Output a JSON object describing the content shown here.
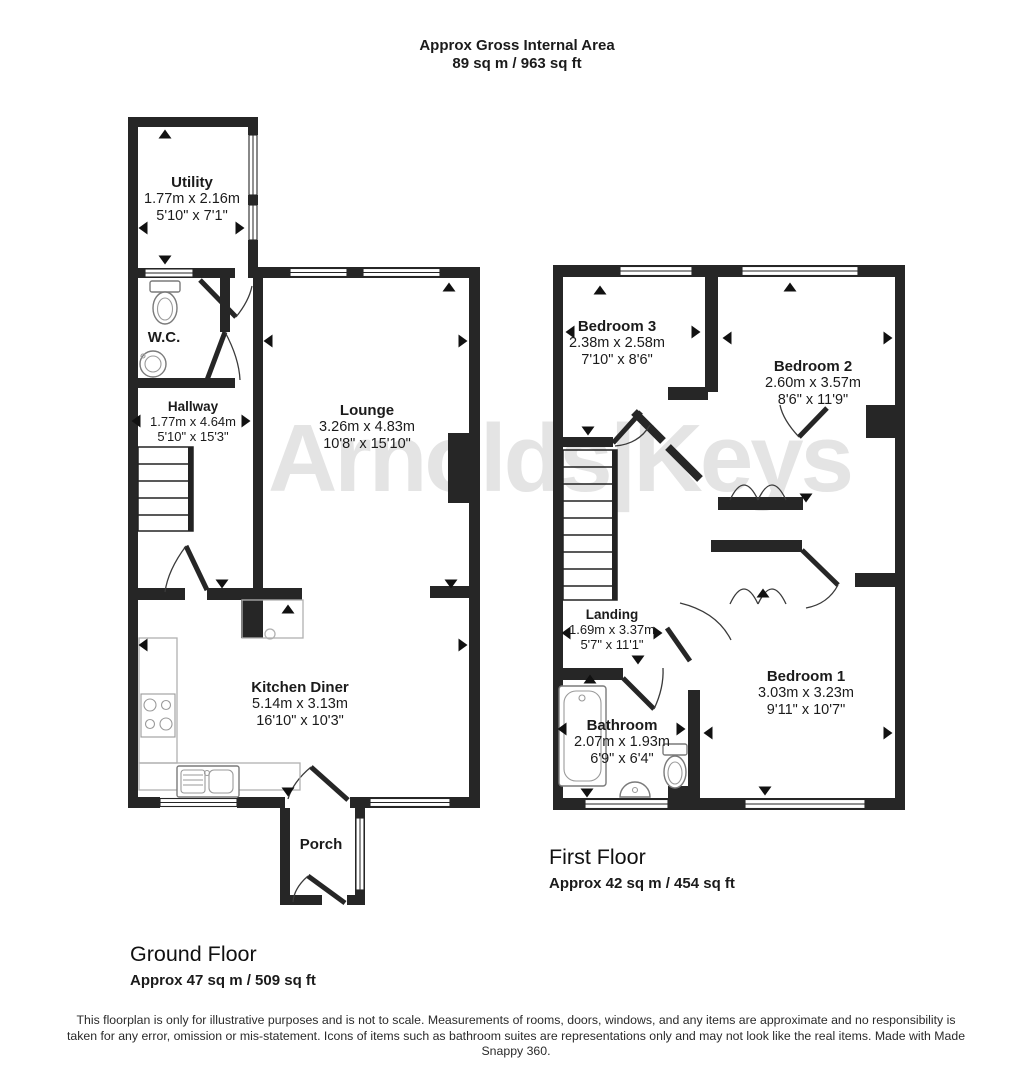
{
  "header": {
    "title": "Approx Gross Internal Area",
    "subtitle": "89 sq m / 963 sq ft"
  },
  "watermark": "Arnolds|Keys",
  "ground_floor": {
    "label": "Ground Floor",
    "area": "Approx 47 sq m / 509 sq ft",
    "rooms": {
      "utility": {
        "name": "Utility",
        "metric": "1.77m x 2.16m",
        "imperial": "5'10\" x 7'1\""
      },
      "wc": {
        "name": "W.C."
      },
      "hallway": {
        "name": "Hallway",
        "metric": "1.77m x 4.64m",
        "imperial": "5'10\" x 15'3\""
      },
      "lounge": {
        "name": "Lounge",
        "metric": "3.26m x 4.83m",
        "imperial": "10'8\" x 15'10\""
      },
      "kitchen": {
        "name": "Kitchen Diner",
        "metric": "5.14m x 3.13m",
        "imperial": "16'10\" x 10'3\""
      },
      "porch": {
        "name": "Porch"
      }
    }
  },
  "first_floor": {
    "label": "First Floor",
    "area": "Approx 42 sq m / 454 sq ft",
    "rooms": {
      "bedroom3": {
        "name": "Bedroom 3",
        "metric": "2.38m x 2.58m",
        "imperial": "7'10\" x 8'6\""
      },
      "bedroom2": {
        "name": "Bedroom 2",
        "metric": "2.60m x 3.57m",
        "imperial": "8'6\" x 11'9\""
      },
      "landing": {
        "name": "Landing",
        "metric": "1.69m x 3.37m",
        "imperial": "5'7\" x 11'1\""
      },
      "bathroom": {
        "name": "Bathroom",
        "metric": "2.07m x 1.93m",
        "imperial": "6'9\" x 6'4\""
      },
      "bedroom1": {
        "name": "Bedroom 1",
        "metric": "3.03m x 3.23m",
        "imperial": "9'11\" x 10'7\""
      }
    }
  },
  "disclaimer": "This floorplan is only for illustrative purposes and is not to scale. Measurements of rooms, doors, windows, and any items are approximate and no responsibility is taken for any error, omission or mis-statement. Icons of items such as bathroom suites are representations only and may not look like the real items. Made with Made Snappy 360."
}
